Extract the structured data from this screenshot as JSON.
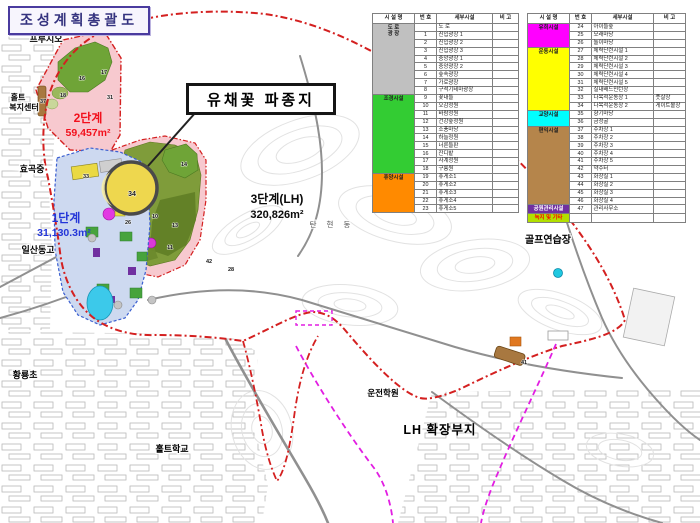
{
  "title": "조성계획총괄도",
  "callout": "유채꽃 파종지",
  "phase_labels": {
    "p2_name": "2단계",
    "p2_area": "59,457m²",
    "p1_name": "1단계",
    "p1_area": "31,130.3m²",
    "p3_name": "3단계(LH)",
    "p3_area": "320,826m²",
    "lh_expansion": "LH 확장부지"
  },
  "places": {
    "prugio": "프루지오",
    "holt_welfare_line1": "홀트",
    "holt_welfare_line2": "복지센터",
    "hyogok_school": "효곡중",
    "ilsandong_school": "일산동고",
    "hwangnyong_school": "황룡초",
    "holt_school": "홀트학교",
    "driving_school": "운전학원",
    "tanhyeon_dong": "탄 현 동",
    "golf_range": "골프연습장"
  },
  "zones": [
    "30",
    "16",
    "17",
    "18",
    "31",
    "37",
    "33",
    "14",
    "34",
    "26",
    "10",
    "13",
    "11",
    "42",
    "28",
    "41"
  ],
  "colors": {
    "park_boundary": "#d42020",
    "lh_boundary": "#e21ee2",
    "phase1_text": "#2436d8",
    "phase2_text": "#f2101c",
    "phase2_fill": "#f7c9cf",
    "phase1_fill": "#cdd9f0",
    "green_zone": "#6fa437",
    "olive_zone": "#7f9c3a",
    "highlight_field": "#eed74e"
  },
  "legend": {
    "headers": [
      "시 설 명",
      "번 호",
      "세부시설",
      "비 고"
    ],
    "left_rows": [
      {
        "cat": "도 로\n광 장",
        "span": 9,
        "color": "#c0c0c0",
        "no": "",
        "name": "도  로",
        "note": ""
      },
      {
        "no": "1",
        "name": "진입광장 1"
      },
      {
        "no": "2",
        "name": "진입광장 2"
      },
      {
        "no": "3",
        "name": "진입광장 3"
      },
      {
        "no": "4",
        "name": "중앙광장 1"
      },
      {
        "no": "5",
        "name": "중앙광장 2"
      },
      {
        "no": "6",
        "name": "숲속광장"
      },
      {
        "no": "7",
        "name": "가로광장"
      },
      {
        "no": "8",
        "name": "구석기테마광장"
      },
      {
        "cat": "조경시설",
        "span": 10,
        "color": "#33cc33",
        "no": "9",
        "name": "꽃내들"
      },
      {
        "no": "10",
        "name": "오감정원"
      },
      {
        "no": "11",
        "name": "바람정원"
      },
      {
        "no": "12",
        "name": "건강숲정원"
      },
      {
        "no": "13",
        "name": "소풍마당"
      },
      {
        "no": "14",
        "name": "하늘정원"
      },
      {
        "no": "15",
        "name": "너른들판"
      },
      {
        "no": "16",
        "name": "잔디밭"
      },
      {
        "no": "17",
        "name": "사계정원"
      },
      {
        "no": "18",
        "name": "구릉원"
      },
      {
        "cat": "휴양시설",
        "span": 5,
        "color": "#ff8a00",
        "no": "19",
        "name": "휴게소1"
      },
      {
        "no": "20",
        "name": "휴게소2"
      },
      {
        "no": "21",
        "name": "휴게소3"
      },
      {
        "no": "22",
        "name": "휴게소4"
      },
      {
        "no": "23",
        "name": "휴게소5"
      }
    ],
    "right_rows": [
      {
        "cat": "유희시설",
        "span": 3,
        "color": "#ff00ff",
        "no": "24",
        "name": "아이들숲"
      },
      {
        "no": "25",
        "name": "모래마당"
      },
      {
        "no": "26",
        "name": "놀이마당"
      },
      {
        "cat": "운동시설",
        "span": 8,
        "color": "#ffff00",
        "no": "27",
        "name": "체력단련시설 1"
      },
      {
        "no": "28",
        "name": "체력단련시설 2"
      },
      {
        "no": "29",
        "name": "체력단련시설 3"
      },
      {
        "no": "30",
        "name": "체력단련시설 4"
      },
      {
        "no": "31",
        "name": "체력단련시설 5"
      },
      {
        "no": "32",
        "name": "실내배드민턴장"
      },
      {
        "no": "33",
        "name": "다목적운동장 1",
        "note": "풋살장"
      },
      {
        "no": "34",
        "name": "다목적운동장 2",
        "note": "게이트볼장"
      },
      {
        "cat": "교양시설",
        "span": 2,
        "color": "#00ffff",
        "no": "35",
        "name": "향기마당"
      },
      {
        "no": "36",
        "name": "금정굴"
      },
      {
        "cat": "편익시설",
        "span": 10,
        "color": "#b5854b",
        "no": "37",
        "name": "주차장 1"
      },
      {
        "no": "38",
        "name": "주차장 2"
      },
      {
        "no": "39",
        "name": "주차장 3"
      },
      {
        "no": "40",
        "name": "주차장 4"
      },
      {
        "no": "41",
        "name": "주차장 5"
      },
      {
        "no": "42",
        "name": "약수터"
      },
      {
        "no": "43",
        "name": "화장실 1"
      },
      {
        "no": "44",
        "name": "화장실 2"
      },
      {
        "no": "45",
        "name": "화장실 3"
      },
      {
        "no": "46",
        "name": "화장실 4"
      },
      {
        "cat": "공원관리시설",
        "span": 1,
        "color": "#7030a0",
        "catText": "#ffffff",
        "no": "47",
        "name": "관리사무소"
      },
      {
        "cat": "녹지 및 기타",
        "span": 1,
        "color": "#b2e000",
        "catText": "#ff0000",
        "no": "",
        "name": "",
        "note": ""
      }
    ]
  }
}
